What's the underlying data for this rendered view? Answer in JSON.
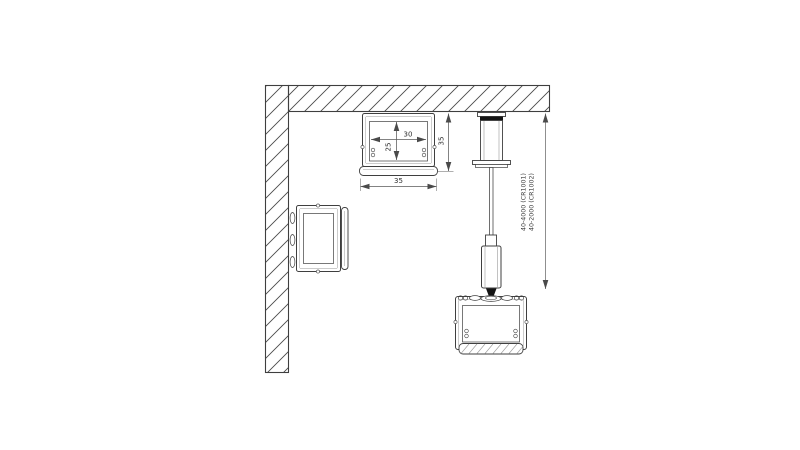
{
  "page": {
    "background": "#ffffff",
    "type_note": "technical installation drawing of aluminium LED profile: ceiling surface mount, wall mount and cable suspension"
  },
  "drawing": {
    "colors": {
      "outline": "#3f3f3f",
      "thin_line": "#8a8a8a",
      "dimension_line": "#5a5a5a",
      "suspension_dim_line": "#8f8f8f",
      "solid_black": "#141414",
      "background": "#ffffff"
    },
    "dims": {
      "inner_width": "30",
      "inner_depth": "25",
      "outer_width": "35",
      "outer_height": "35"
    },
    "suspension_range": {
      "line1": "40-4000 (CR1001)",
      "line2": "40-2000 (CR1002)"
    }
  }
}
